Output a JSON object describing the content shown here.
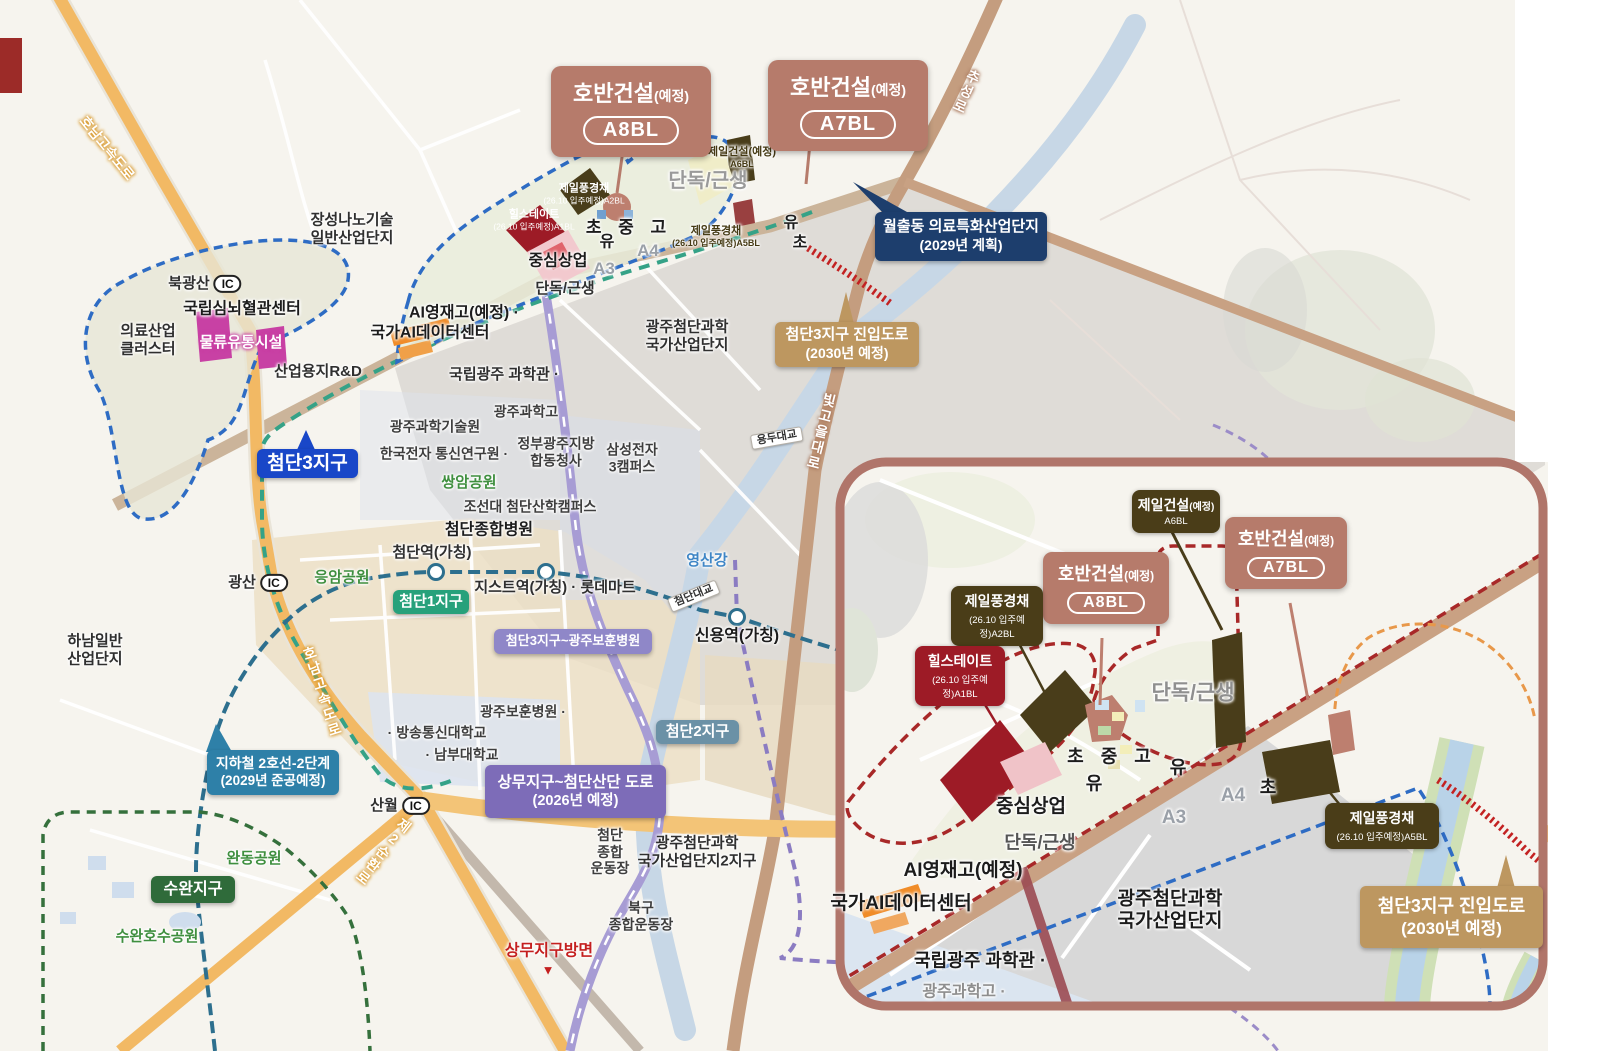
{
  "colors": {
    "salmon_box": "#b67b6b",
    "olive_box": "#4a3d18",
    "darkred_box": "#9d1b26",
    "navy_box": "#1d3e6d",
    "tan_box": "#bd9760",
    "blue_box": "#1947c8",
    "green_box": "#27a17b",
    "steel_box": "#6b91a6",
    "teal_box": "#2e80a8",
    "darkgreen_box": "#2f6b3a",
    "lilac_box": "#8f87c8",
    "purple_box": "#7d6cb8",
    "orange_road": "#f2b964",
    "brown_road": "#c49d7f",
    "river": "#c7d7e6",
    "inset_border": "#b0756a",
    "blue_boundary": "#2e6cc4",
    "red_boundary": "#a82828",
    "metro_line": "#2d6f8e",
    "subway2_line": "#35a287"
  },
  "main": {
    "construction_callouts": [
      {
        "name": "hoban-a8bl-main",
        "title": "호반건설",
        "suffix": "(예정)",
        "pill": "A8BL"
      },
      {
        "name": "hoban-a7bl-main",
        "title": "호반건설",
        "suffix": "(예정)",
        "pill": "A7BL"
      }
    ],
    "info_boxes": {
      "wolchul": {
        "line1": "월출동 의료특화산업단지",
        "line2": "(2029년 계획)"
      },
      "jinip": {
        "line1": "첨단3지구 진입도로",
        "line2": "(2030년 예정)"
      },
      "subway2": {
        "line1": "지하철 2호선-2단계",
        "line2": "(2029년 준공예정)"
      },
      "sangmu_road": {
        "line1": "상무지구~첨단산단 도로",
        "line2": "(2026년 예정)"
      },
      "bohun_road": {
        "label": "첨단3지구~광주보훈병원"
      },
      "district3": {
        "label": "첨단3지구"
      },
      "district1": {
        "label": "첨단1지구"
      },
      "district2": {
        "label": "첨단2지구"
      },
      "suwan": {
        "label": "수완지구"
      }
    },
    "labels": [
      {
        "n": "jangseong-nano-label",
        "ls": [
          "장성나노기술",
          "일반산업단지"
        ],
        "x": 352,
        "y": 229,
        "c": "b15"
      },
      {
        "n": "bukgwangsan-ic",
        "t": "북광산",
        "ic": "IC",
        "x": 205,
        "y": 284,
        "c": "b15"
      },
      {
        "n": "simnoe-center-label",
        "t": "국립심뇌혈관센터",
        "x": 242,
        "y": 310,
        "c": "b16"
      },
      {
        "n": "uiryo-cluster-label",
        "ls": [
          "의료산업",
          "클러스터"
        ],
        "x": 148,
        "y": 340,
        "c": "b15"
      },
      {
        "n": "mullyu-label",
        "t": "물류유통시설",
        "x": 241,
        "y": 343,
        "c": "wh-mag"
      },
      {
        "n": "saneopyongji-label",
        "t": "산업용지R&D",
        "x": 318,
        "y": 372,
        "c": "b15"
      },
      {
        "n": "ai-yeongjae-label",
        "t": "AI영재고(예정) ·",
        "x": 464,
        "y": 314,
        "c": "b16"
      },
      {
        "n": "ai-datacenter-label",
        "t": "국가AI데이터센터",
        "x": 430,
        "y": 334,
        "c": "b16"
      },
      {
        "n": "science-museum-label",
        "t": "국립광주 과학관 ·",
        "x": 504,
        "y": 375,
        "c": "b15"
      },
      {
        "n": "gwahakgo-label",
        "t": "광주과학고",
        "x": 526,
        "y": 412,
        "c": "n14"
      },
      {
        "n": "gist-label",
        "t": "광주과학기술원",
        "x": 435,
        "y": 427,
        "c": "n14"
      },
      {
        "n": "etri-label",
        "t": "한국전자 통신연구원 ·",
        "x": 444,
        "y": 454,
        "c": "n14"
      },
      {
        "n": "jeongbu-cheongsa-label",
        "ls": [
          "정부광주지방",
          "합동청사"
        ],
        "x": 556,
        "y": 452,
        "c": "n14"
      },
      {
        "n": "samsung-label",
        "ls": [
          "삼성전자",
          "3캠퍼스"
        ],
        "x": 632,
        "y": 458,
        "c": "n14"
      },
      {
        "n": "cheomdan-sandan-label",
        "ls": [
          "광주첨단과학",
          "국가산업단지"
        ],
        "x": 687,
        "y": 336,
        "c": "b15"
      },
      {
        "n": "ssangam-park-label",
        "t": "쌍암공원",
        "x": 469,
        "y": 483,
        "c": "green"
      },
      {
        "n": "chosun-campus-label",
        "t": "조선대 첨단산학캠퍼스",
        "x": 530,
        "y": 507,
        "c": "n14"
      },
      {
        "n": "cheomdan-hospital-label",
        "t": "첨단종합병원",
        "x": 489,
        "y": 531,
        "c": "b16"
      },
      {
        "n": "cheomdan-station-label",
        "t": "첨단역(가칭)",
        "x": 432,
        "y": 553,
        "c": "b15"
      },
      {
        "n": "eungam-park-label",
        "t": "응암공원",
        "x": 342,
        "y": 578,
        "c": "green"
      },
      {
        "n": "gwangsan-ic",
        "t": "광산",
        "ic": "IC",
        "x": 258,
        "y": 583,
        "c": "b15"
      },
      {
        "n": "gist-station-label",
        "t": "지스트역(가칭) · 롯데마트",
        "x": 555,
        "y": 588,
        "c": "b15"
      },
      {
        "n": "yeongsan-river-label",
        "t": "영산강",
        "x": 707,
        "y": 561,
        "c": "blue"
      },
      {
        "n": "sinyong-station-label",
        "t": "신용역(가칭)",
        "x": 737,
        "y": 637,
        "c": "b16"
      },
      {
        "n": "hanam-sandan-label",
        "ls": [
          "하남일반",
          "산업단지"
        ],
        "x": 95,
        "y": 650,
        "c": "b15"
      },
      {
        "n": "bohun-hospital-label",
        "t": "광주보훈병원 ·",
        "x": 523,
        "y": 712,
        "c": "n14"
      },
      {
        "n": "bangsong-univ-label",
        "t": "· 방송통신대학교",
        "x": 437,
        "y": 733,
        "c": "n14"
      },
      {
        "n": "nambu-univ-label",
        "t": "· 남부대학교",
        "x": 462,
        "y": 755,
        "c": "n14"
      },
      {
        "n": "cheomdan-stadium-label",
        "ls": [
          "첨단",
          "종합",
          "운동장"
        ],
        "x": 610,
        "y": 852,
        "c": "n14"
      },
      {
        "n": "bukgu-stadium-label",
        "ls": [
          "북구",
          "종합운동장"
        ],
        "x": 641,
        "y": 916,
        "c": "n14"
      },
      {
        "n": "sandan2-label",
        "ls": [
          "광주첨단과학",
          "국가산업단지2지구"
        ],
        "x": 697,
        "y": 852,
        "c": "b15"
      },
      {
        "n": "wandong-park-label",
        "t": "완동공원",
        "x": 254,
        "y": 859,
        "c": "green"
      },
      {
        "n": "suwan-lake-park-label",
        "t": "수완호수공원",
        "x": 157,
        "y": 937,
        "c": "green"
      },
      {
        "n": "sanwol-ic",
        "t": "산월",
        "ic": "IC",
        "x": 400,
        "y": 806,
        "c": "b15"
      },
      {
        "n": "dandok-geunsaeng-big",
        "t": "단독/근생",
        "x": 708,
        "y": 182,
        "c": "gray-lg"
      },
      {
        "n": "dandok-geunsaeng-small",
        "t": "단독/근생",
        "x": 565,
        "y": 289,
        "c": "b15"
      },
      {
        "n": "jungsim-sangup-label",
        "t": "중심상업",
        "x": 558,
        "y": 262,
        "c": "b16"
      },
      {
        "n": "cho-jung-go-label",
        "t": "초 중 고",
        "x": 629,
        "y": 228,
        "c": "b17"
      },
      {
        "n": "yu-label-1",
        "t": "유",
        "x": 607,
        "y": 243,
        "c": "b16"
      },
      {
        "n": "yu-label-2",
        "t": "유",
        "x": 791,
        "y": 224,
        "c": "b16"
      },
      {
        "n": "cho-label-2",
        "t": "초",
        "x": 800,
        "y": 244,
        "c": "b16"
      },
      {
        "n": "a4-label",
        "t": "A4",
        "x": 648,
        "y": 251,
        "c": "az"
      },
      {
        "n": "a3-label",
        "t": "A3",
        "x": 604,
        "y": 269,
        "c": "az"
      },
      {
        "n": "jeil-a6bl-main-label",
        "ls": [
          "제일건설(예정)",
          "A6BL"
        ],
        "x": 742,
        "y": 158,
        "c": "tiny-olive"
      },
      {
        "n": "jpg-a2bl-main-label",
        "ls": [
          "제일풍경채",
          "(26.10 입주예정)A2BL"
        ],
        "x": 584,
        "y": 194,
        "c": "tiny-w"
      },
      {
        "n": "hillstate-a1bl-main-label",
        "ls": [
          "힐스테이트",
          "(26.10 입주예정)A1BL"
        ],
        "x": 534,
        "y": 220,
        "c": "tiny-w"
      },
      {
        "n": "jpg-a5bl-main-label",
        "ls": [
          "제일풍경채",
          "(26.10 입주예정)A5BL"
        ],
        "x": 716,
        "y": 237,
        "c": "tiny-olive"
      },
      {
        "n": "yongdu-bridge-label",
        "t": "용두대교",
        "x": 777,
        "y": 438,
        "c": "bridge",
        "r": -10
      },
      {
        "n": "cheomdan-bridge-label",
        "t": "첨단대교",
        "x": 694,
        "y": 596,
        "c": "bridge",
        "r": -22
      },
      {
        "n": "honam-expwy-label-1",
        "t": "호남고속도로",
        "x": 107,
        "y": 148,
        "c": "road-o",
        "r": 51
      },
      {
        "n": "honam-expwy-label-2",
        "t": "호남고속도로",
        "x": 322,
        "y": 692,
        "c": "road-o vert",
        "r": -18
      },
      {
        "n": "je2-sunhwan-label",
        "t": "제2순환로",
        "x": 383,
        "y": 852,
        "c": "road-o vert",
        "r": 38
      },
      {
        "n": "chuseong-ro-label",
        "t": "추성로",
        "x": 966,
        "y": 92,
        "c": "road-b vert",
        "r": 24
      },
      {
        "n": "bitgoeul-daero-label",
        "t": "빛고을대로",
        "x": 821,
        "y": 432,
        "c": "road-b vert",
        "r": 14
      },
      {
        "n": "sangmu-direction-label",
        "t": "상무지구방면",
        "x": 549,
        "y": 952,
        "c": "red-dir"
      },
      {
        "n": "sangmu-direction-arrow",
        "t": "▼",
        "x": 548,
        "y": 970,
        "c": "red-tri"
      }
    ]
  },
  "inset": {
    "construction_callouts": [
      {
        "name": "hoban-a8bl-inset",
        "title": "호반건설",
        "suffix": "(예정)",
        "pill": "A8BL"
      },
      {
        "name": "hoban-a7bl-inset",
        "title": "호반건설",
        "suffix": "(예정)",
        "pill": "A7BL"
      }
    ],
    "dark_callouts": [
      {
        "name": "jeil-a6bl-inset",
        "title": "제일건설",
        "suffix": "(예정)",
        "sub": "A6BL"
      },
      {
        "name": "jpg-a2bl-inset",
        "title": "제일풍경채",
        "suffix": "",
        "sub": "(26.10 입주예정)A2BL"
      },
      {
        "name": "hillstate-a1bl-inset",
        "title": "힐스테이트",
        "suffix": "",
        "sub": "(26.10 입주예정)A1BL"
      },
      {
        "name": "jpg-a5bl-inset",
        "title": "제일풍경채",
        "suffix": "",
        "sub": "(26.10 입주예정)A5BL"
      }
    ],
    "info_boxes": {
      "jinip": {
        "line1": "첨단3지구 진입도로",
        "line2": "(2030년 예정)"
      }
    },
    "labels": [
      {
        "n": "dandok-inset-label-1",
        "t": "단독/근생",
        "x": 1193,
        "y": 694,
        "c": "gray-xl"
      },
      {
        "n": "jungsim-inset-label",
        "t": "중심상업",
        "x": 1031,
        "y": 807,
        "c": "b19"
      },
      {
        "n": "dandok-inset-label-2",
        "t": "단독/근생",
        "x": 1040,
        "y": 843,
        "c": "gray-18"
      },
      {
        "n": "ai-yeongjae-inset-label",
        "t": "AI영재고(예정)",
        "x": 963,
        "y": 871,
        "c": "b19"
      },
      {
        "n": "ai-datacenter-inset-label",
        "t": "국가AI데이터센터",
        "x": 901,
        "y": 904,
        "c": "b19"
      },
      {
        "n": "museum-inset-label",
        "t": "국립광주 과학관 ·",
        "x": 980,
        "y": 961,
        "c": "b18"
      },
      {
        "n": "gwahakgo-inset-label",
        "t": "광주과학고 ·",
        "x": 964,
        "y": 993,
        "c": "n16g"
      },
      {
        "n": "sandan-inset-label",
        "ls": [
          "광주첨단과학",
          "국가산업단지"
        ],
        "x": 1170,
        "y": 911,
        "c": "b19"
      },
      {
        "n": "cho-jung-go-inset-label",
        "t": "초 중 고",
        "x": 1112,
        "y": 757,
        "c": "b18s"
      },
      {
        "n": "yu-inset-label-1",
        "t": "유",
        "x": 1094,
        "y": 784,
        "c": "b18"
      },
      {
        "n": "yu-inset-label-2",
        "t": "유",
        "x": 1178,
        "y": 768,
        "c": "b18"
      },
      {
        "n": "cho-inset-label-2",
        "t": "초",
        "x": 1268,
        "y": 788,
        "c": "b18"
      },
      {
        "n": "a4-inset-label",
        "t": "A4",
        "x": 1233,
        "y": 796,
        "c": "az19"
      },
      {
        "n": "a3-inset-label",
        "t": "A3",
        "x": 1174,
        "y": 818,
        "c": "az19"
      }
    ]
  }
}
